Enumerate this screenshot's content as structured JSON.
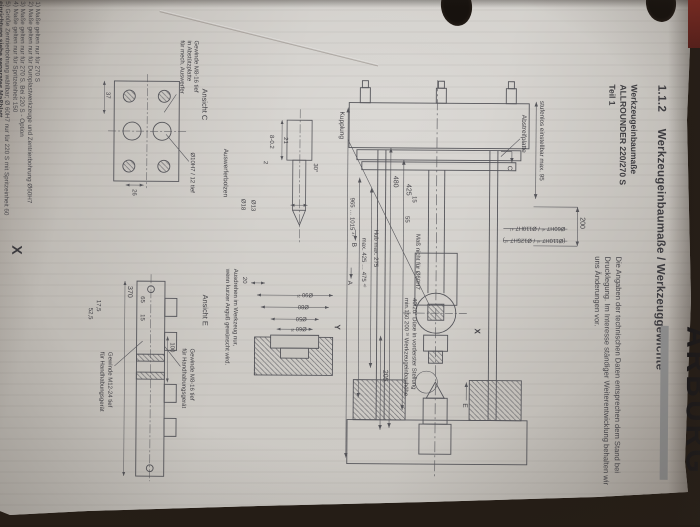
{
  "page": {
    "title_number": "1.1.2",
    "title": "Werkzeugeinbaumaße / Werkzeuggewichte"
  },
  "header": {
    "line1": "Werkzeugeinbaumaße",
    "line2": "ALLROUNDER 220/270 S",
    "line3": "Teil 1"
  },
  "intro": {
    "line1": "Die Angaben der technischen Daten entsprechen dem Stand bei",
    "line2": "Drucklegung. Im Interesse ständiger Weiterentwicklung behalten wir",
    "line3": "uns Änderungen vor."
  },
  "logo": {
    "text": "ARBURG"
  },
  "drawing": {
    "abstreifplatte": "Abstreifplatte",
    "stufenlos": "stufenlos einstellbar max. 95",
    "d200": "200",
    "dia_line1": "Ø60H7 ⁴⁾ / Ø110H7 ⁴⁾",
    "dia_line2": "(Ø110H7 ⁴⁾ / Ø125H7 ⁴⁾)",
    "kupplung": "Kupplung",
    "d480": "480",
    "d425": "425",
    "d15": "15",
    "d55": "55",
    "mass_hint": "Maß nicht für Ø60H7",
    "hub": "Hub max. 275",
    "max425": "max. 425 … 475 ⁴⁾",
    "d965": "965 … 1015 ⁴⁾",
    "d205": "205",
    "x_label": "X",
    "y_label": "Y",
    "a_label": "A",
    "b_label": "B",
    "c_label": "C",
    "e_label": "E",
    "duese1": "40/20° Düse in vorderster Stellung",
    "duese2": "min.150  200 ³⁾ Werkzeugeinbauhöhe",
    "ansicht_c": "Ansicht  C",
    "dia10": "Ø10H7 / 12 tief",
    "gew_c1": "Gewinde M8-16 tief",
    "gew_c2": "in Abstützplatte",
    "gew_c3": "für mech. Auswerfer",
    "auswerferbolzen": "Auswerferbolzen",
    "d18": "Ø18",
    "d13": "Ø13",
    "d8": "8-0.2",
    "d2": "2",
    "d21": "21",
    "d26": "26",
    "d37": "37",
    "d30": "30°",
    "ansicht_e": "Ansicht  E",
    "d370": "370",
    "d100": "100",
    "d65": "65",
    "d15b": "15",
    "d175": "17,5",
    "d525": "52,5",
    "gm8_l1": "Gewinde M8-16 tief",
    "gm8_l2": "für Handhabungsgerät",
    "gm12_l1": "Gewinde M12-24 tief",
    "gm12_l2": "für Handhabungsgerät",
    "d80": "Ø80",
    "d90": "Ø90 ²⁾",
    "d50": "Ø50",
    "d60": "Ø60 ²⁾",
    "d20": "20",
    "note1": "Ausdrehen im Werkzeug nur,",
    "note2": "wenn kurzer Anguß gewünscht wird."
  },
  "footnotes": {
    "f1": "1) Maße gelten nur für 270 S",
    "f2": "2) Maße gelten nur für Duroplastwerkzeuge und Zentrierbohrung Ø60H7",
    "f3": "3) Maße gelten nur für 270 S. Bei 220 S - Option",
    "f4": "4) Maße gelten nur für Spritzeinheit 150",
    "f5": "5) Größe Zentrierbohrung wählbar; Ø 60H7 nur für 220 S mit Spritzeinheit 60",
    "f6": "einrichtung siehe separates Maßblatt"
  },
  "colors": {
    "paper": "#c9c6c1",
    "desk": "#241c15",
    "ink": "#3d3c40",
    "line": "#55555a",
    "logo_red_tab": "#7d2a22",
    "logo_black": "#15151a"
  }
}
